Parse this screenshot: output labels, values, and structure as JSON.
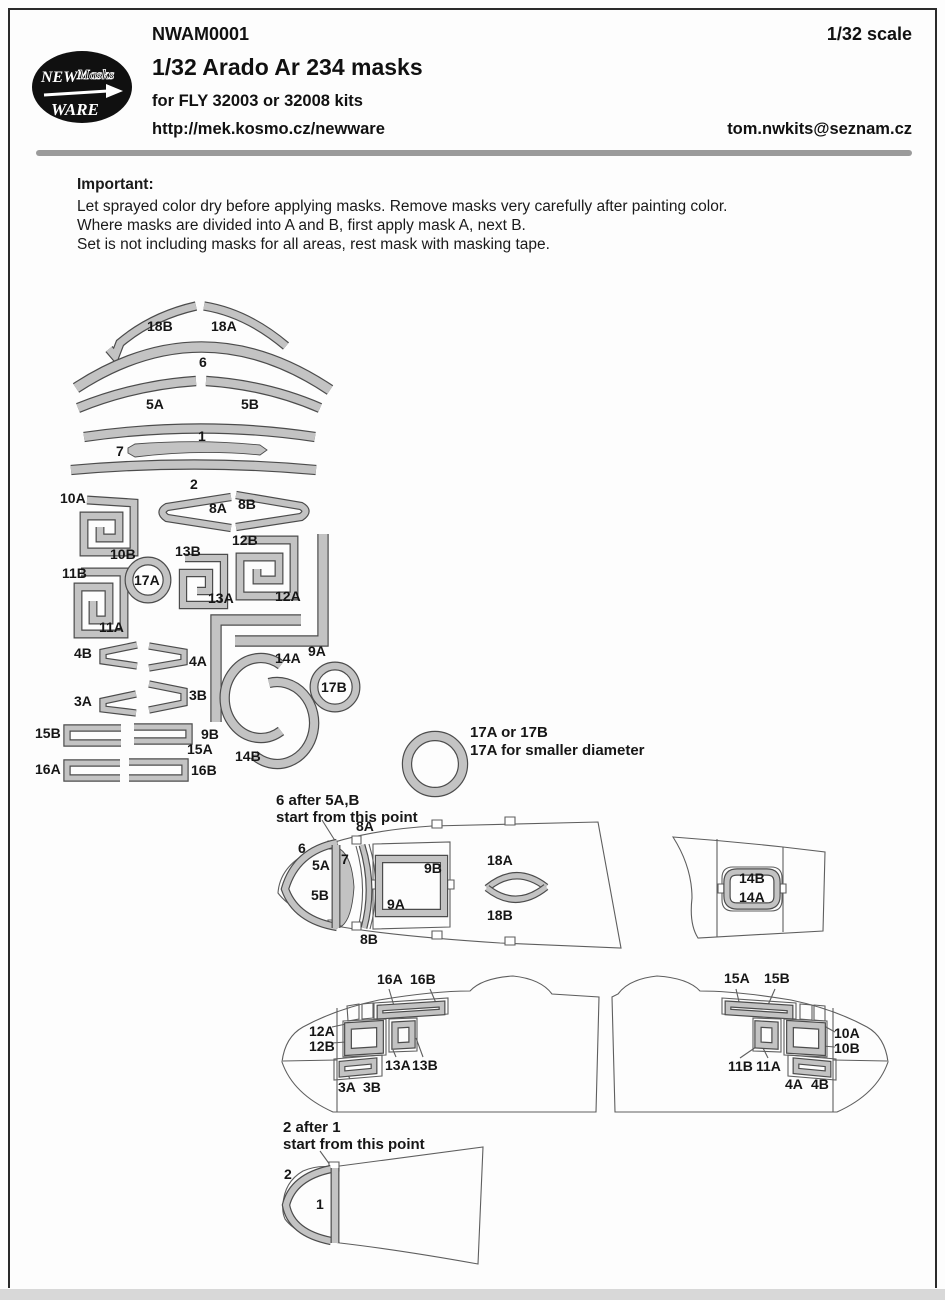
{
  "header": {
    "code": "NWAM0001",
    "title": "1/32 Arado Ar 234 masks",
    "subtitle": "for FLY 32003 or 32008 kits",
    "url": "http://mek.kosmo.cz/newware",
    "scale": "1/32 scale",
    "email": "tom.nwkits@seznam.cz",
    "logo": {
      "word1": "NEW",
      "word2": "Masks",
      "word3": "WARE"
    }
  },
  "important": {
    "heading": "Important:",
    "lines": [
      "Let sprayed color dry before applying masks. Remove masks very carefully after painting color.",
      "Where masks are divided into A and B, first apply mask A, next B.",
      "Set is not including masks for all areas, rest mask with masking tape."
    ]
  },
  "colors": {
    "mask_fill": "#c3c3c3",
    "mask_edge": "#4c4c4c",
    "outline": "#5e5e5e"
  },
  "labels": {
    "s18B": "18B",
    "s18A": "18A",
    "s6": "6",
    "s5A": "5A",
    "s5B": "5B",
    "s1": "1",
    "s7": "7",
    "s2": "2",
    "s10A": "10A",
    "s8A": "8A",
    "s8B": "8B",
    "s10B": "10B",
    "s13B": "13B",
    "s12B": "12B",
    "s11B": "11B",
    "s17A": "17A",
    "s13A": "13A",
    "s12A": "12A",
    "s11A": "11A",
    "s4B": "4B",
    "s4A": "4A",
    "s14A": "14A",
    "s9A": "9A",
    "s3A": "3A",
    "s3B": "3B",
    "s17B": "17B",
    "s15B": "15B",
    "s9B": "9B",
    "s15A": "15A",
    "s14B": "14B",
    "s16A": "16A",
    "s16B": "16B"
  },
  "ring_note": {
    "line1": "17A or 17B",
    "line2": "17A for smaller diameter"
  },
  "canopy": {
    "note1": "6 after 5A,B",
    "note2": "start from this point",
    "m6": "6",
    "m5A": "5A",
    "m5B": "5B",
    "m7": "7",
    "m8A": "8A",
    "m8B": "8B",
    "m9A": "9A",
    "m9B": "9B",
    "m18A": "18A",
    "m18B": "18B",
    "m14A": "14A",
    "m14B": "14B"
  },
  "left_side": {
    "m16A": "16A",
    "m16B": "16B",
    "m12A": "12A",
    "m12B": "12B",
    "m13A": "13A",
    "m13B": "13B",
    "m3A": "3A",
    "m3B": "3B"
  },
  "right_side": {
    "m15A": "15A",
    "m15B": "15B",
    "m10A": "10A",
    "m10B": "10B",
    "m11A": "11A",
    "m11B": "11B",
    "m4A": "4A",
    "m4B": "4B"
  },
  "nose": {
    "note1": "2 after 1",
    "note2": "start from this point",
    "m2": "2",
    "m1": "1"
  }
}
